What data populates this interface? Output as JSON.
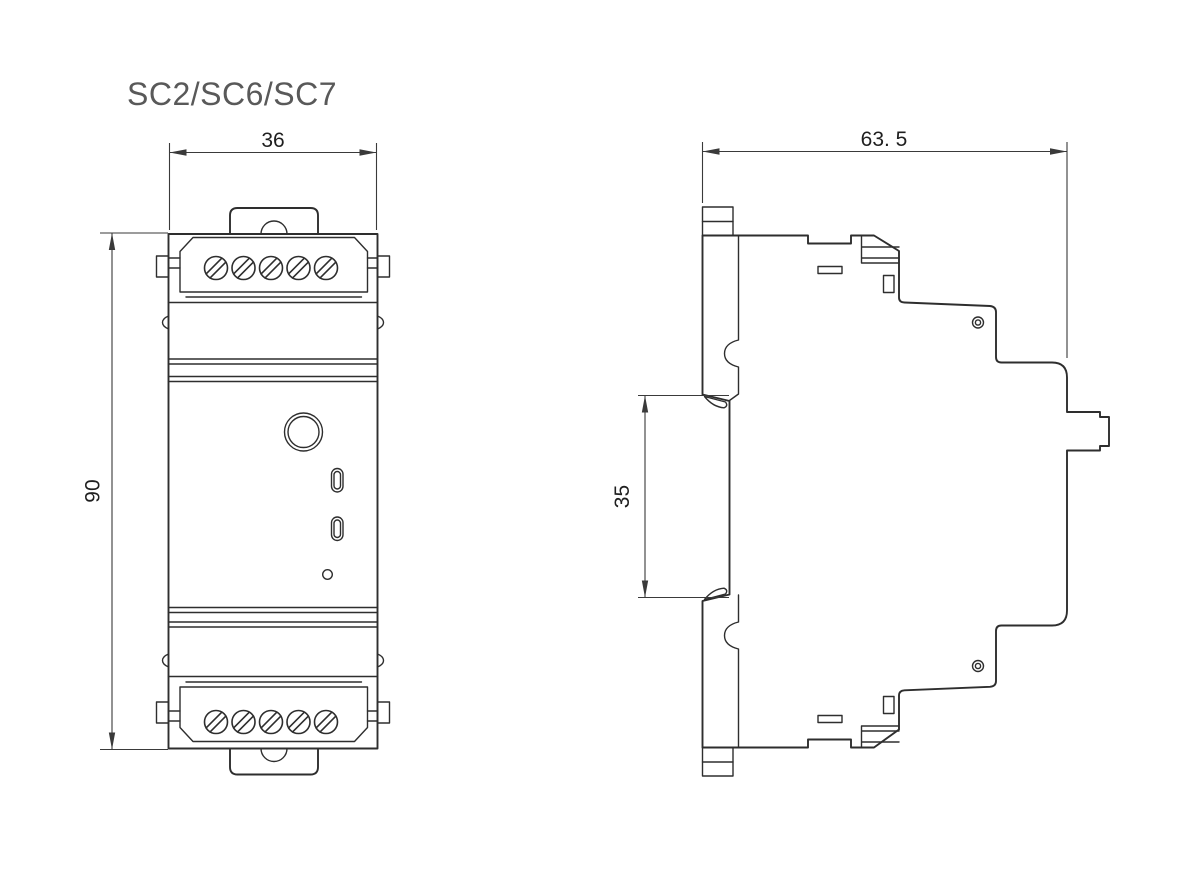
{
  "title": "SC2/SC6/SC7",
  "drawing": {
    "front_view": {
      "width_dim": "36",
      "height_dim": "90"
    },
    "side_view": {
      "depth_dim": "63. 5",
      "rail_dim": "35"
    }
  },
  "colors": {
    "line": "#2e2e2e",
    "dim_line": "#3a3a3a",
    "text": "#1f1f1f",
    "title_text": "#595959",
    "background": "#ffffff"
  }
}
